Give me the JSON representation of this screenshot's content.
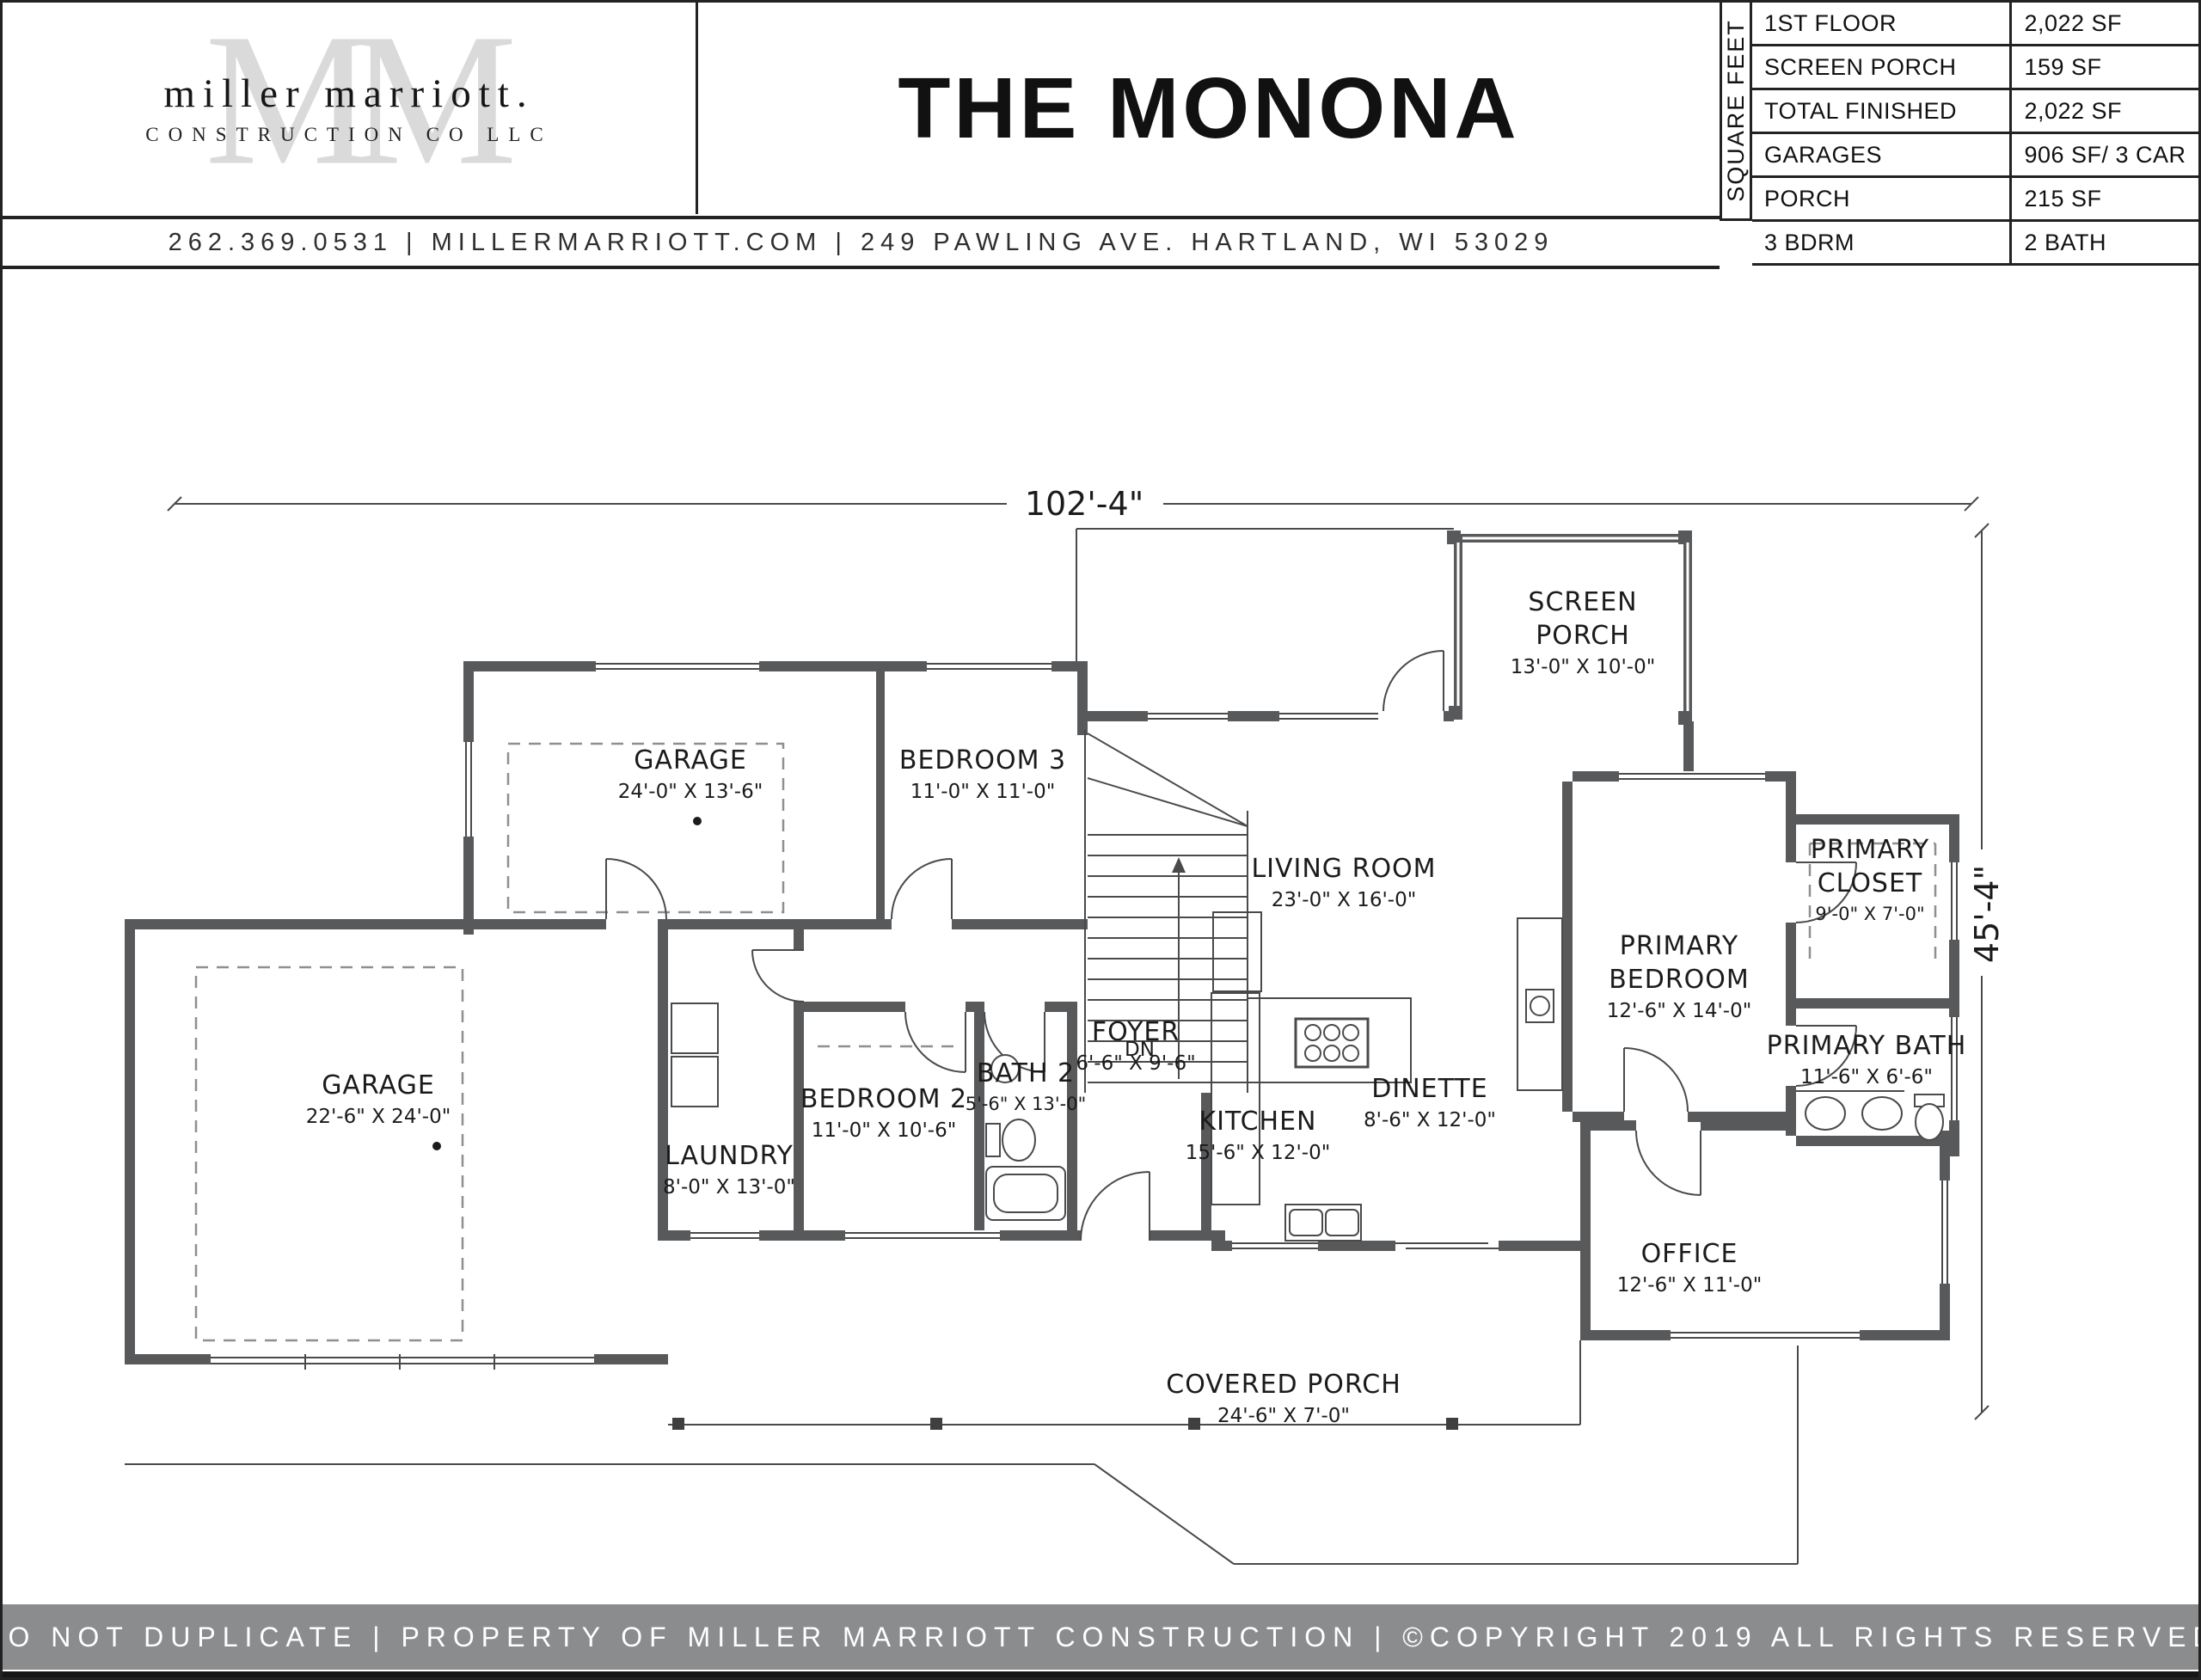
{
  "header": {
    "logo": {
      "monogram": "MM",
      "name_line": "miller marriott.",
      "sub_line": "CONSTRUCTION CO LLC"
    },
    "title": "THE MONONA",
    "contact": "262.369.0531  |  MILLERMARRIOTT.COM  |  249 PAWLING AVE. HARTLAND, WI 53029"
  },
  "spec_table": {
    "vertical_label": "SQUARE FEET",
    "rows": [
      {
        "label": "1ST FLOOR",
        "value": "2,022 SF"
      },
      {
        "label": "SCREEN PORCH",
        "value": "159 SF"
      },
      {
        "label": "TOTAL FINISHED",
        "value": "2,022 SF"
      },
      {
        "label": "GARAGES",
        "value": "906 SF/ 3 CAR"
      },
      {
        "label": "PORCH",
        "value": "215 SF"
      },
      {
        "label": "3 BDRM",
        "value": "2 BATH"
      }
    ]
  },
  "plan": {
    "overall_width": "102'-4\"",
    "overall_depth": "45'-4\"",
    "stairs_label": "DN",
    "rooms": [
      {
        "line1": "GARAGE",
        "dims": "24'-0\" X 13'-6\""
      },
      {
        "line1": "BEDROOM 3",
        "dims": "11'-0\" X 11'-0\""
      },
      {
        "line1": "GARAGE",
        "dims": "22'-6\" X 24'-0\""
      },
      {
        "line1": "LAUNDRY",
        "dims": "8'-0\" X 13'-0\""
      },
      {
        "line1": "BEDROOM 2",
        "dims": "11'-0\" X 10'-6\""
      },
      {
        "line1": "BATH 2",
        "dims": "5'-6\" X 13'-0\""
      },
      {
        "line1": "FOYER",
        "dims": "6'-6\" X 9'-6\""
      },
      {
        "line1": "LIVING ROOM",
        "dims": "23'-0\" X 16'-0\""
      },
      {
        "line1": "SCREEN",
        "line2": "PORCH",
        "dims": "13'-0\" X 10'-0\""
      },
      {
        "line1": "KITCHEN",
        "dims": "15'-6\" X 12'-0\""
      },
      {
        "line1": "DINETTE",
        "dims": "8'-6\" X 12'-0\""
      },
      {
        "line1": "PRIMARY",
        "line2": "BEDROOM",
        "dims": "12'-6\" X 14'-0\""
      },
      {
        "line1": "PRIMARY",
        "line2": "CLOSET",
        "dims": "9'-0\" X 7'-0\""
      },
      {
        "line1": "PRIMARY BATH",
        "dims": "11'-6\" X 6'-6\""
      },
      {
        "line1": "OFFICE",
        "dims": "12'-6\" X 11'-0\""
      },
      {
        "line1": "COVERED PORCH",
        "dims": "24'-6\" X 7'-0\""
      }
    ]
  },
  "footer": {
    "notice": "DO NOT DUPLICATE | PROPERTY OF MILLER MARRIOTT CONSTRUCTION | ©COPYRIGHT 2019 ALL RIGHTS RESERVED"
  }
}
